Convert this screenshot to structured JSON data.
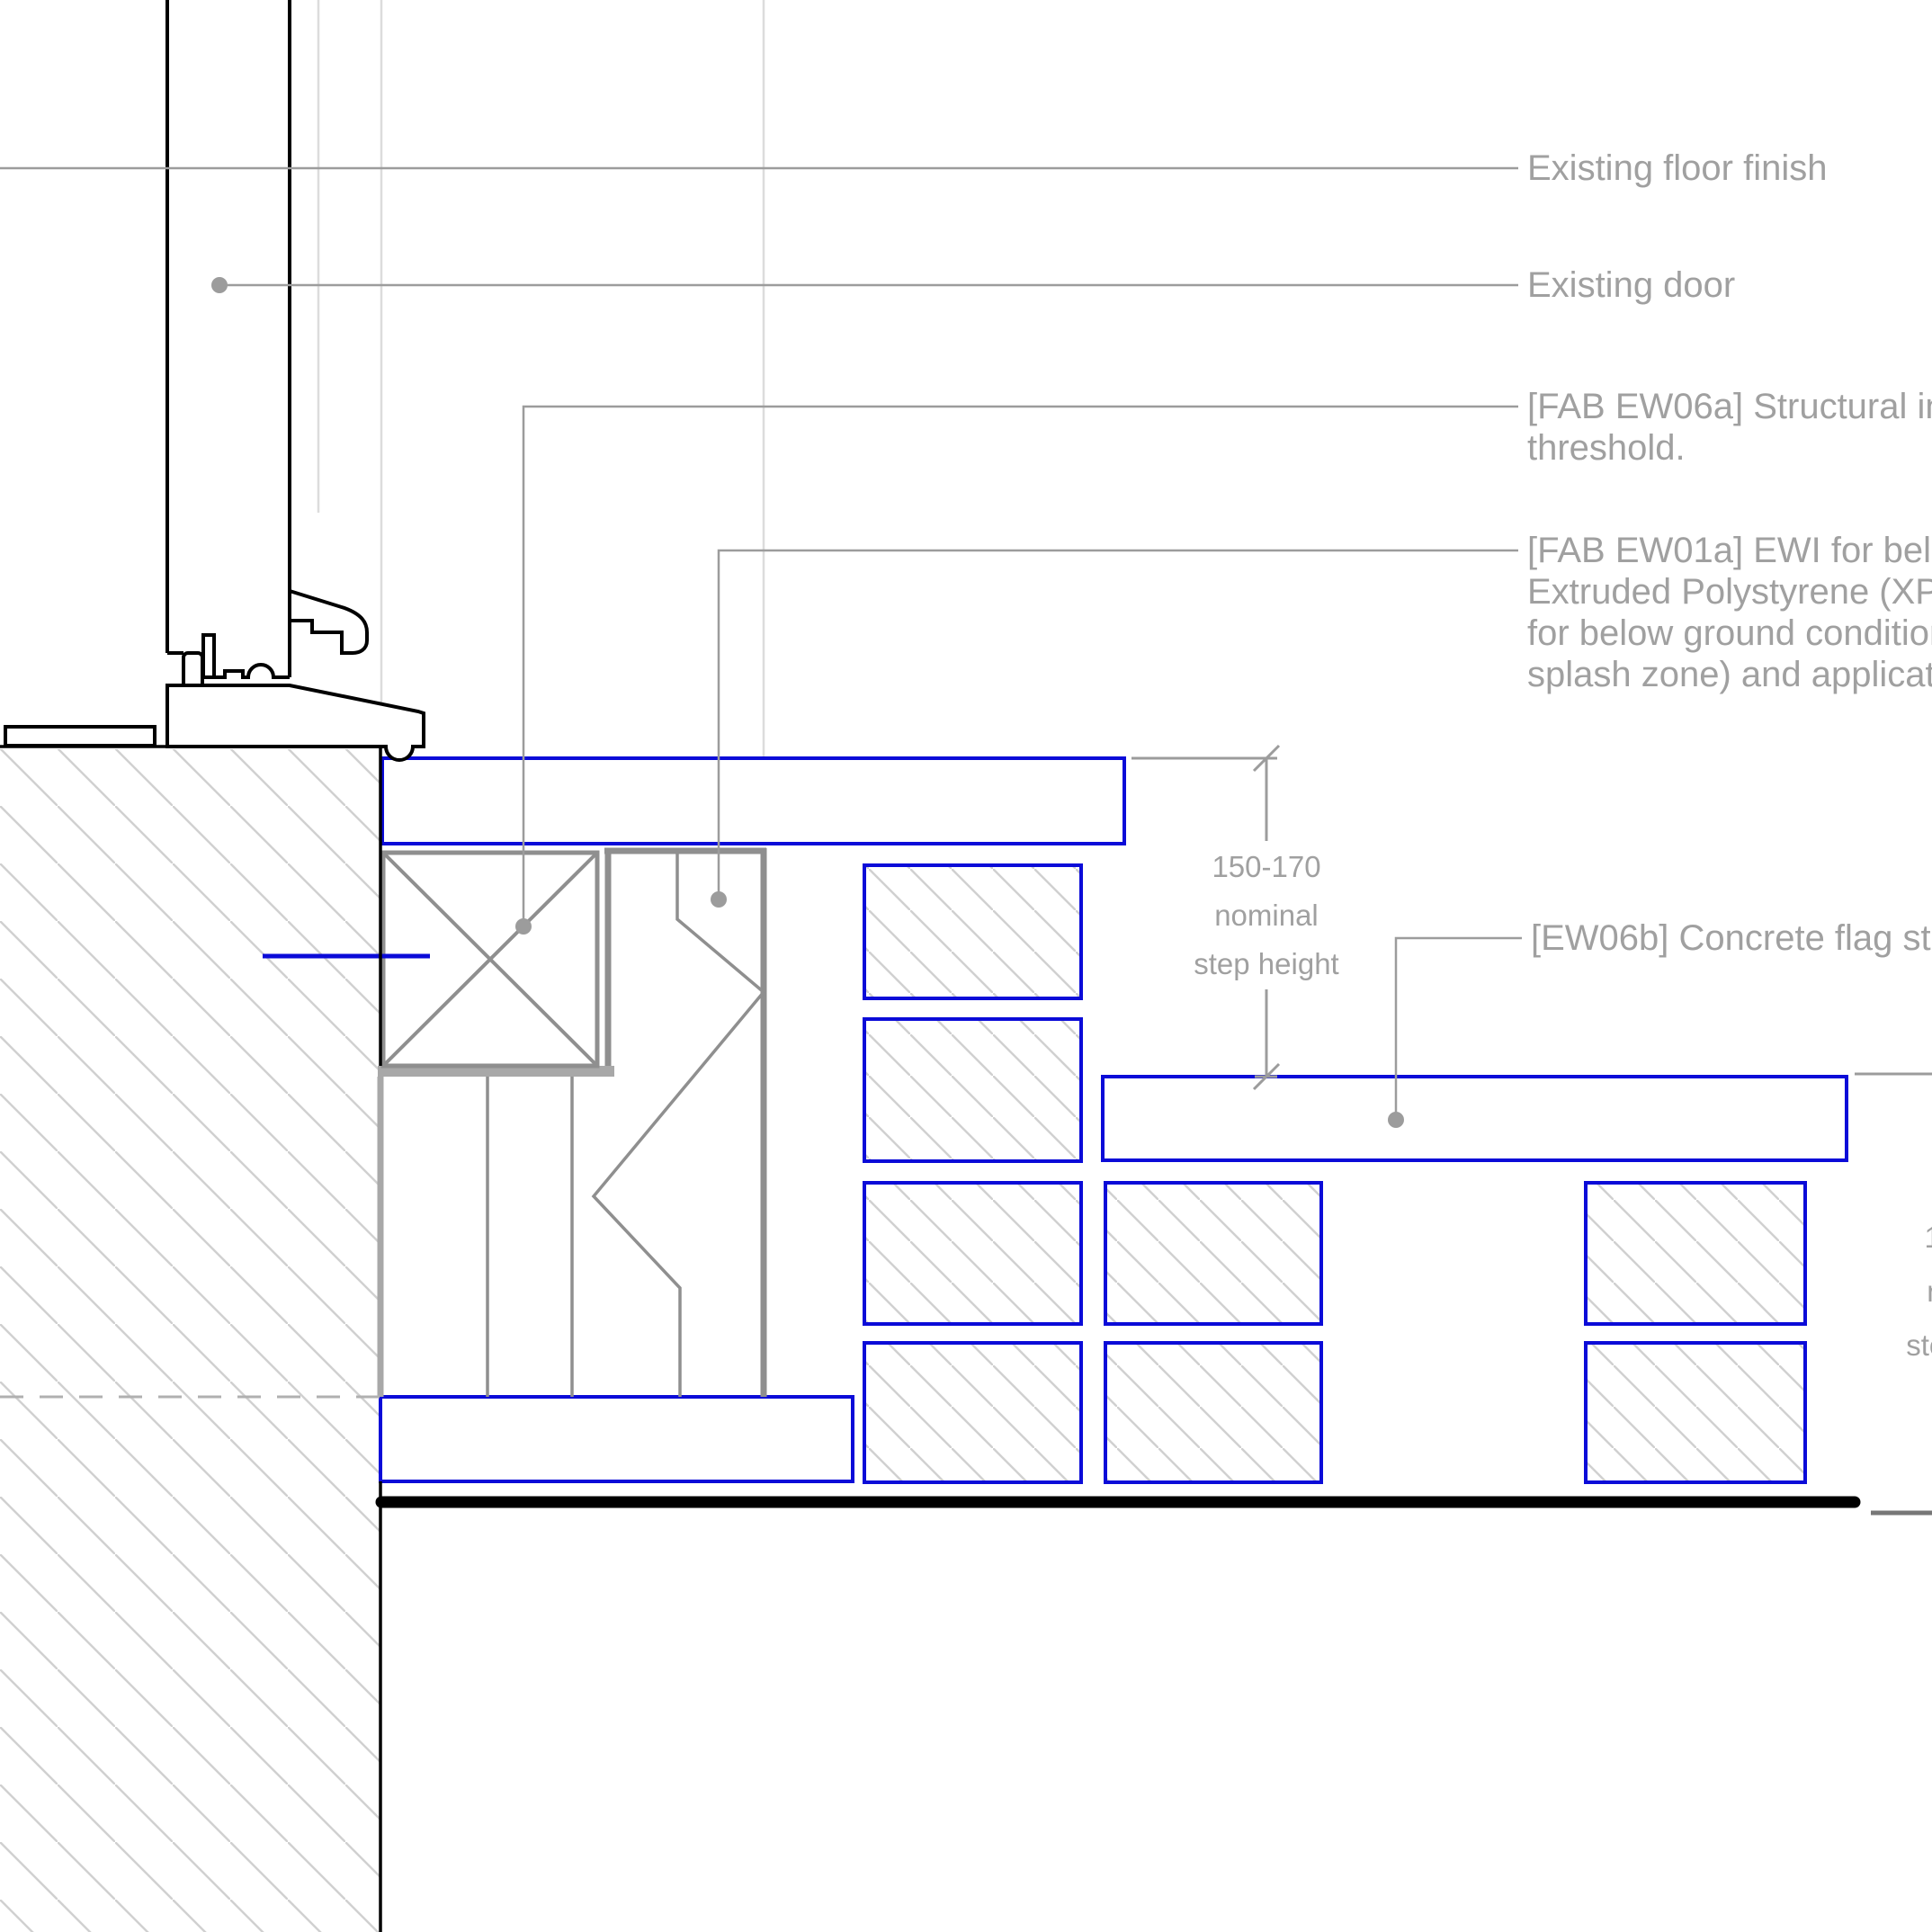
{
  "drawing": {
    "callouts": {
      "existing_floor_finish": "Existing floor finish",
      "existing_door": "Existing door",
      "fab_ew06a": {
        "lines": [
          "[FAB EW06a] Structural insulated",
          "threshold."
        ]
      },
      "fab_ew01a": {
        "lines": [
          "[FAB EW01a] EWI for below",
          "Extruded Polystyrene (XPS)",
          "for below ground conditions",
          "splash zone) and application"
        ]
      },
      "ew06b": "[EW06b] Concrete flag steps"
    },
    "dimension": {
      "lines": [
        "150-170",
        "nominal",
        "step height"
      ]
    },
    "colors": {
      "line_blue": "#0b0bd8",
      "leader_gray": "#9c9c9c",
      "text_gray": "#a0a0a0",
      "hatch_gray": "#d0d0d0",
      "component_gray": "#8f8f8f",
      "projection_gray": "#dcdcdc",
      "black": "#000000"
    }
  }
}
